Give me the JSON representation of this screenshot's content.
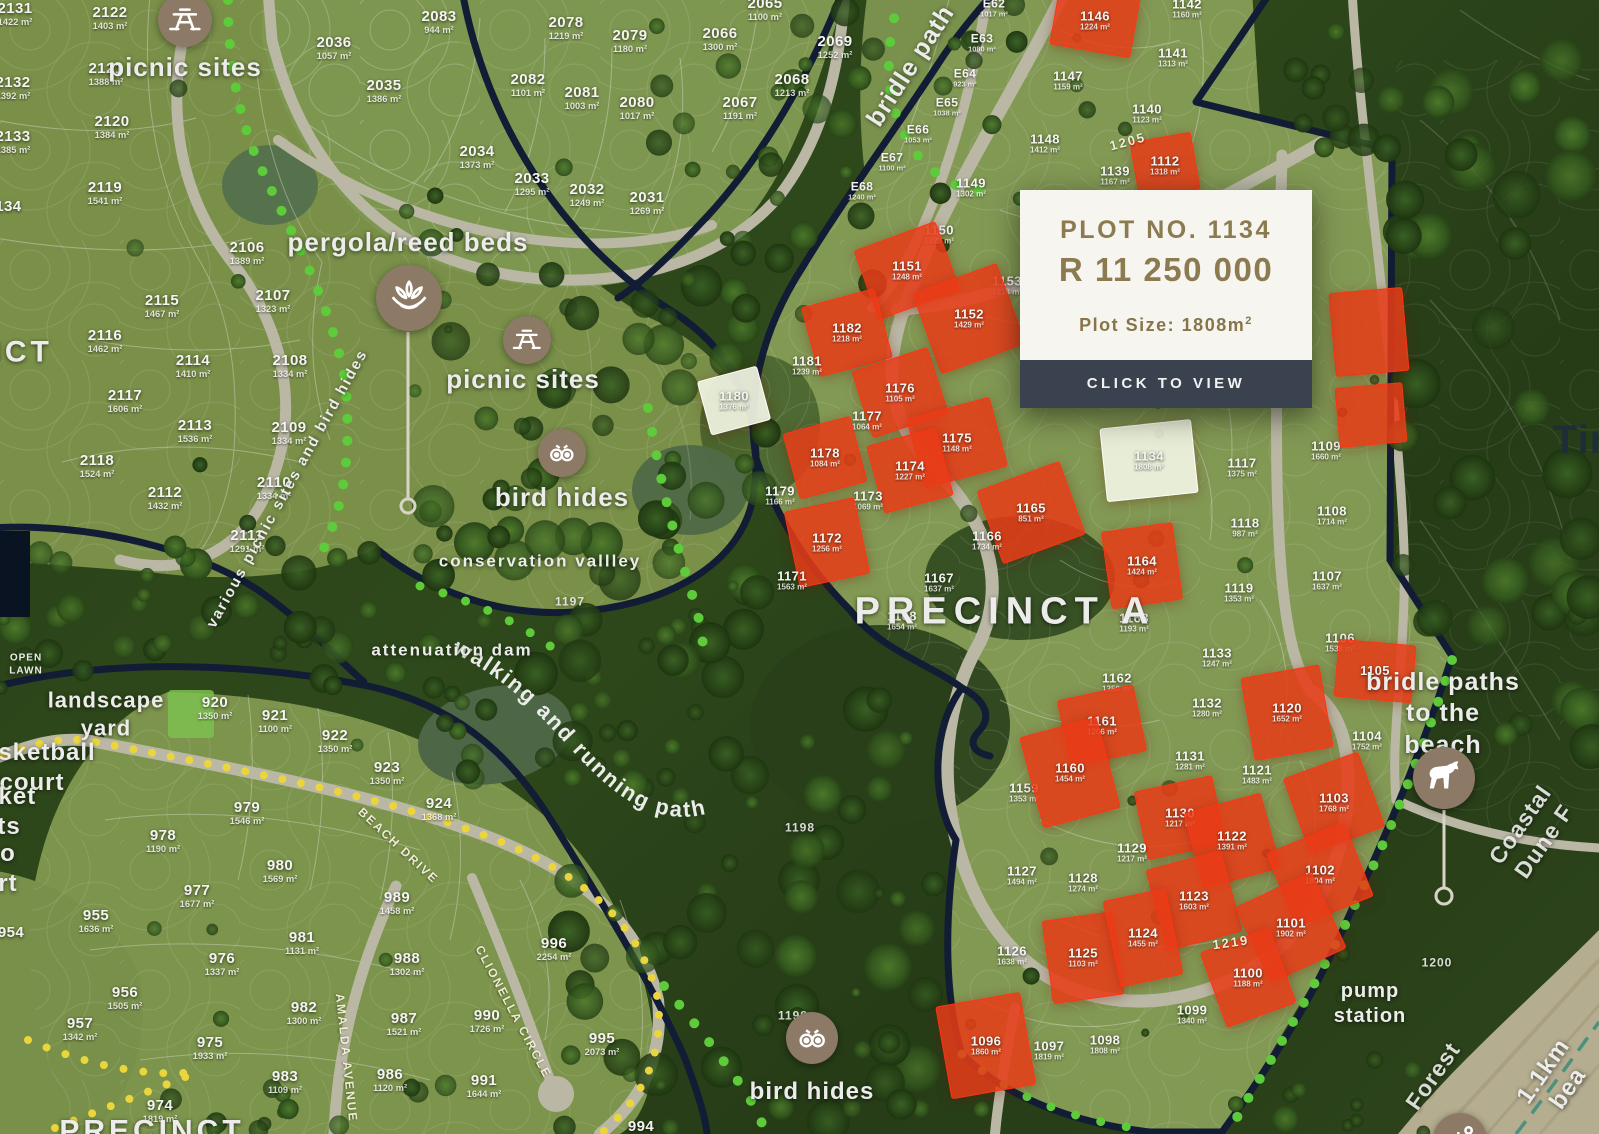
{
  "popup": {
    "plot_label": "PLOT NO. 1134",
    "price": "R 11 250 000",
    "size_label": "Plot Size: 1808m",
    "size_sup": "2",
    "button": "CLICK TO VIEW"
  },
  "colors": {
    "accent_gold": "#8c7b51",
    "button_bg": "#39424e",
    "sold_red": "#e83b17",
    "selected_plot": "#f0f4e3",
    "boundary_navy": "#13203c",
    "road": "#cfccb8",
    "trail_dot_green": "#5ecb3a",
    "trail_dot_yellow": "#ead63c"
  },
  "labels": [
    {
      "t": "picnic sites",
      "x": 185,
      "y": 67,
      "fs": 26
    },
    {
      "t": "pergola/reed beds",
      "x": 408,
      "y": 242,
      "fs": 26
    },
    {
      "t": "picnic sites",
      "x": 523,
      "y": 379,
      "fs": 26
    },
    {
      "t": "bird hides",
      "x": 562,
      "y": 497,
      "fs": 26
    },
    {
      "t": "conservation vallley",
      "x": 540,
      "y": 561,
      "fs": 17,
      "ls": 2
    },
    {
      "t": "attenuation dam",
      "x": 452,
      "y": 650,
      "fs": 17,
      "ls": 2
    },
    {
      "t": "various picnic sites and bird hides",
      "x": 288,
      "y": 489,
      "fs": 15,
      "rot": -61,
      "ls": 2
    },
    {
      "t": "bridle path",
      "x": 911,
      "y": 66,
      "fs": 25,
      "rot": -57
    },
    {
      "t": "PRECINCT A",
      "x": 1005,
      "y": 612,
      "fs": 38,
      "ls": 7
    },
    {
      "t": "bridle paths\nto the beach",
      "x": 1443,
      "y": 714,
      "fs": 25
    },
    {
      "t": "bird hides",
      "x": 812,
      "y": 1092,
      "fs": 24
    },
    {
      "t": "pump\nstation",
      "x": 1370,
      "y": 1004,
      "fs": 20
    },
    {
      "t": "OPEN\nLAWN",
      "x": 26,
      "y": 665,
      "fs": 10,
      "ls": 1
    },
    {
      "t": "landscape\nyard",
      "x": 106,
      "y": 714,
      "fs": 22
    },
    {
      "t": "basketball\ncourt",
      "x": 32,
      "y": 768,
      "fs": 24
    },
    {
      "t": "cricket\nnets",
      "x": -6,
      "y": 812,
      "fs": 24
    },
    {
      "t": "o\nrt",
      "x": 8,
      "y": 869,
      "fs": 24
    },
    {
      "t": "NCT",
      "x": 16,
      "y": 352,
      "fs": 30,
      "ls": 4
    },
    {
      "t": "PRECINCT",
      "x": 152,
      "y": 1131,
      "fs": 30,
      "ls": 4
    },
    {
      "t": "Tin",
      "x": 1584,
      "y": 440,
      "fs": 40,
      "cls": "dark"
    },
    {
      "t": "Coastal Dune F",
      "x": 1532,
      "y": 833,
      "fs": 23,
      "rot": -55,
      "op": 0.9
    },
    {
      "t": "Forest",
      "x": 1433,
      "y": 1076,
      "fs": 23,
      "rot": -55,
      "op": 0.9
    },
    {
      "t": "1.1km bea",
      "x": 1556,
      "y": 1080,
      "fs": 24,
      "rot": -55
    },
    {
      "t": "BEACH DRIVE",
      "x": 398,
      "y": 846,
      "fs": 12,
      "rot": 43,
      "cls": "rl"
    },
    {
      "t": "AMALDA AVENUE",
      "x": 346,
      "y": 1058,
      "fs": 12,
      "rot": 84,
      "cls": "rl"
    },
    {
      "t": "CLIONELLA CIRCLE",
      "x": 513,
      "y": 1012,
      "fs": 12,
      "rot": 62,
      "cls": "rl"
    },
    {
      "t": "1205",
      "x": 1128,
      "y": 142,
      "fs": 13,
      "rot": -15,
      "cls": "rl"
    },
    {
      "t": "1219",
      "x": 1231,
      "y": 943,
      "fs": 13,
      "rot": -8,
      "cls": "rl"
    },
    {
      "t": "1197",
      "x": 570,
      "y": 602,
      "fs": 12,
      "cls": "ref"
    },
    {
      "t": "1198",
      "x": 800,
      "y": 828,
      "fs": 12,
      "cls": "ref"
    },
    {
      "t": "1199",
      "x": 793,
      "y": 1016,
      "fs": 12,
      "cls": "ref"
    },
    {
      "t": "1200",
      "x": 1437,
      "y": 963,
      "fs": 12,
      "cls": "ref"
    }
  ],
  "icons": [
    {
      "name": "picnic-table",
      "g": "picnic",
      "x": 185,
      "y": 20,
      "r": 27
    },
    {
      "name": "lotus",
      "g": "lotus",
      "x": 409,
      "y": 298,
      "r": 33
    },
    {
      "name": "picnic-table",
      "g": "picnic",
      "x": 527,
      "y": 340,
      "r": 24
    },
    {
      "name": "binoculars",
      "g": "binoc",
      "x": 562,
      "y": 453,
      "r": 24
    },
    {
      "name": "binoculars",
      "g": "binoc",
      "x": 812,
      "y": 1038,
      "r": 26
    },
    {
      "name": "horse",
      "g": "horse",
      "x": 1444,
      "y": 778,
      "r": 31
    },
    {
      "name": "beach-umbrella",
      "g": "beach",
      "x": 1460,
      "y": 1140,
      "r": 27
    }
  ],
  "plots": [
    {
      "n": "2131",
      "a": "1422 m²",
      "x": 15,
      "y": 14,
      "fs": 15
    },
    {
      "n": "2122",
      "a": "1403 m²",
      "x": 110,
      "y": 18,
      "fs": 15
    },
    {
      "n": "2132",
      "a": "1392 m²",
      "x": 13,
      "y": 88,
      "fs": 15
    },
    {
      "n": "2121",
      "a": "1388 m²",
      "x": 106,
      "y": 74,
      "fs": 15
    },
    {
      "n": "2120",
      "a": "1384 m²",
      "x": 112,
      "y": 127,
      "fs": 15
    },
    {
      "n": "2133",
      "a": "1385 m²",
      "x": 13,
      "y": 142,
      "fs": 15
    },
    {
      "n": "2119",
      "a": "1541 m²",
      "x": 105,
      "y": 193,
      "fs": 15
    },
    {
      "n": "2134",
      "a": "",
      "x": 4,
      "y": 207,
      "fs": 15
    },
    {
      "n": "2106",
      "a": "1389 m²",
      "x": 247,
      "y": 253,
      "fs": 15
    },
    {
      "n": "2107",
      "a": "1323 m²",
      "x": 273,
      "y": 301,
      "fs": 15
    },
    {
      "n": "2115",
      "a": "1467 m²",
      "x": 162,
      "y": 306,
      "fs": 15
    },
    {
      "n": "2116",
      "a": "1462 m²",
      "x": 105,
      "y": 341,
      "fs": 15
    },
    {
      "n": "2114",
      "a": "1410 m²",
      "x": 193,
      "y": 366,
      "fs": 15
    },
    {
      "n": "2108",
      "a": "1334 m²",
      "x": 290,
      "y": 366,
      "fs": 15
    },
    {
      "n": "2117",
      "a": "1606 m²",
      "x": 125,
      "y": 401,
      "fs": 15
    },
    {
      "n": "2113",
      "a": "1536 m²",
      "x": 195,
      "y": 431,
      "fs": 15
    },
    {
      "n": "2109",
      "a": "1334 m²",
      "x": 289,
      "y": 433,
      "fs": 15
    },
    {
      "n": "2118",
      "a": "1524 m²",
      "x": 97,
      "y": 466,
      "fs": 15
    },
    {
      "n": "2110",
      "a": "1334 m²",
      "x": 274,
      "y": 488,
      "fs": 15
    },
    {
      "n": "2112",
      "a": "1432 m²",
      "x": 165,
      "y": 498,
      "fs": 15
    },
    {
      "n": "2111",
      "a": "1291 m²",
      "x": 247,
      "y": 541,
      "fs": 15
    },
    {
      "n": "2083",
      "a": "944 m²",
      "x": 439,
      "y": 22,
      "fs": 15
    },
    {
      "n": "2036",
      "a": "1057 m²",
      "x": 334,
      "y": 48,
      "fs": 15
    },
    {
      "n": "2035",
      "a": "1386 m²",
      "x": 384,
      "y": 91,
      "fs": 15
    },
    {
      "n": "2078",
      "a": "1219 m²",
      "x": 566,
      "y": 28,
      "fs": 15
    },
    {
      "n": "2079",
      "a": "1180 m²",
      "x": 630,
      "y": 41,
      "fs": 15
    },
    {
      "n": "2082",
      "a": "1101 m²",
      "x": 528,
      "y": 85,
      "fs": 15
    },
    {
      "n": "2081",
      "a": "1003 m²",
      "x": 582,
      "y": 98,
      "fs": 15
    },
    {
      "n": "2080",
      "a": "1017 m²",
      "x": 637,
      "y": 108,
      "fs": 15
    },
    {
      "n": "2034",
      "a": "1373 m²",
      "x": 477,
      "y": 157,
      "fs": 15
    },
    {
      "n": "2033",
      "a": "1295 m²",
      "x": 532,
      "y": 184,
      "fs": 15
    },
    {
      "n": "2032",
      "a": "1249 m²",
      "x": 587,
      "y": 195,
      "fs": 15
    },
    {
      "n": "2031",
      "a": "1269 m²",
      "x": 647,
      "y": 203,
      "fs": 15
    },
    {
      "n": "2065",
      "a": "1100 m²",
      "x": 765,
      "y": 9,
      "fs": 15
    },
    {
      "n": "2066",
      "a": "1300 m²",
      "x": 720,
      "y": 39,
      "fs": 15
    },
    {
      "n": "2069",
      "a": "1252 m²",
      "x": 835,
      "y": 47,
      "fs": 15
    },
    {
      "n": "2068",
      "a": "1213 m²",
      "x": 792,
      "y": 85,
      "fs": 15
    },
    {
      "n": "2067",
      "a": "1191 m²",
      "x": 740,
      "y": 108,
      "fs": 15
    },
    {
      "n": "E62",
      "a": "1017 m²",
      "x": 994,
      "y": 8,
      "fs": 12
    },
    {
      "n": "E63",
      "a": "1080 m²",
      "x": 982,
      "y": 43,
      "fs": 12
    },
    {
      "n": "E64",
      "a": "923 m²",
      "x": 965,
      "y": 78,
      "fs": 12
    },
    {
      "n": "E65",
      "a": "1038 m²",
      "x": 947,
      "y": 107,
      "fs": 12
    },
    {
      "n": "E66",
      "a": "1053 m²",
      "x": 918,
      "y": 134,
      "fs": 12
    },
    {
      "n": "E67",
      "a": "1100 m²",
      "x": 892,
      "y": 162,
      "fs": 12
    },
    {
      "n": "E68",
      "a": "1240 m²",
      "x": 862,
      "y": 191,
      "fs": 12
    },
    {
      "n": "1146",
      "a": "1224 m²",
      "x": 1095,
      "y": 21,
      "st": "s",
      "pw": 80,
      "ph": 60,
      "pr": 10
    },
    {
      "n": "1142",
      "a": "1160 m²",
      "x": 1187,
      "y": 9
    },
    {
      "n": "1141",
      "a": "1313 m²",
      "x": 1173,
      "y": 58
    },
    {
      "n": "1147",
      "a": "1159 m²",
      "x": 1068,
      "y": 81
    },
    {
      "n": "1140",
      "a": "1123 m²",
      "x": 1147,
      "y": 114
    },
    {
      "n": "1148",
      "a": "1412 m²",
      "x": 1045,
      "y": 144
    },
    {
      "n": "1112",
      "a": "1318 m²",
      "x": 1165,
      "y": 166,
      "st": "s",
      "pw": 60,
      "ph": 56,
      "pr": -10
    },
    {
      "n": "1139",
      "a": "1167 m²",
      "x": 1115,
      "y": 176
    },
    {
      "n": "1149",
      "a": "1302 m²",
      "x": 971,
      "y": 188
    },
    {
      "n": "1150",
      "a": "1223 m²",
      "x": 939,
      "y": 235
    },
    {
      "n": "1151",
      "a": "1248 m²",
      "x": 907,
      "y": 271,
      "st": "s",
      "pw": 85,
      "ph": 72,
      "pr": -20
    },
    {
      "n": "1153",
      "a": "1218 m²",
      "x": 1007,
      "y": 286
    },
    {
      "n": "1152",
      "a": "1429 m²",
      "x": 969,
      "y": 319,
      "st": "s",
      "pw": 88,
      "ph": 84,
      "pr": -20
    },
    {
      "n": "1182",
      "a": "1218 m²",
      "x": 847,
      "y": 333,
      "st": "s",
      "pw": 74,
      "ph": 70,
      "pr": -15
    },
    {
      "n": "1181",
      "a": "1239 m²",
      "x": 807,
      "y": 366
    },
    {
      "n": "1180",
      "a": "1376 m²",
      "x": 734,
      "y": 401,
      "st": "w",
      "pw": 60,
      "ph": 54,
      "pr": -15
    },
    {
      "n": "1176",
      "a": "1105 m²",
      "x": 900,
      "y": 393,
      "st": "s",
      "pw": 78,
      "ph": 68,
      "pr": -18
    },
    {
      "n": "1177",
      "a": "1064 m²",
      "x": 867,
      "y": 421
    },
    {
      "n": "1178",
      "a": "1084 m²",
      "x": 825,
      "y": 458,
      "st": "s",
      "pw": 68,
      "ph": 66,
      "pr": -15
    },
    {
      "n": "1175",
      "a": "1148 m²",
      "x": 957,
      "y": 443,
      "st": "s",
      "pw": 84,
      "ph": 70,
      "pr": -15
    },
    {
      "n": "1174",
      "a": "1227 m²",
      "x": 910,
      "y": 471,
      "st": "s",
      "pw": 70,
      "ph": 68,
      "pr": -15
    },
    {
      "n": "1179",
      "a": "1166 m²",
      "x": 780,
      "y": 496
    },
    {
      "n": "1173",
      "a": "1069 m²",
      "x": 868,
      "y": 501
    },
    {
      "n": "1172",
      "a": "1256 m²",
      "x": 827,
      "y": 543,
      "st": "s",
      "pw": 70,
      "ph": 76,
      "pr": -12
    },
    {
      "n": "1165",
      "a": "851 m²",
      "x": 1031,
      "y": 513,
      "st": "s",
      "pw": 86,
      "ph": 76,
      "pr": -20
    },
    {
      "n": "1166",
      "a": "1734 m²",
      "x": 987,
      "y": 541
    },
    {
      "n": "1171",
      "a": "1563 m²",
      "x": 792,
      "y": 581
    },
    {
      "n": "1167",
      "a": "1637 m²",
      "x": 939,
      "y": 583
    },
    {
      "n": "1168",
      "a": "1654 m²",
      "x": 902,
      "y": 621
    },
    {
      "n": "1134",
      "a": "1808 m²",
      "x": 1149,
      "y": 461,
      "st": "w",
      "pw": 90,
      "ph": 72,
      "pr": -6
    },
    {
      "n": "1117",
      "a": "1375 m²",
      "x": 1242,
      "y": 468
    },
    {
      "n": "1118",
      "a": "987 m²",
      "x": 1245,
      "y": 528
    },
    {
      "n": "1109",
      "a": "1660 m²",
      "x": 1326,
      "y": 451
    },
    {
      "n": "1108",
      "a": "1714 m²",
      "x": 1332,
      "y": 516
    },
    {
      "n": "1107",
      "a": "1637 m²",
      "x": 1327,
      "y": 581
    },
    {
      "n": "1106",
      "a": "1538 m²",
      "x": 1340,
      "y": 643
    },
    {
      "n": "1119",
      "a": "1353 m²",
      "x": 1239,
      "y": 593
    },
    {
      "n": "1133",
      "a": "1247 m²",
      "x": 1217,
      "y": 658
    },
    {
      "n": "1163",
      "a": "1193 m²",
      "x": 1134,
      "y": 623
    },
    {
      "n": "1164",
      "a": "1424 m²",
      "x": 1142,
      "y": 566,
      "st": "s",
      "pw": 70,
      "ph": 76,
      "pr": -8
    },
    {
      "n": "1105",
      "a": "",
      "x": 1375,
      "y": 671,
      "st": "s",
      "pw": 76,
      "ph": 56,
      "pr": 5
    },
    {
      "n": "1104",
      "a": "1752 m²",
      "x": 1367,
      "y": 741
    },
    {
      "n": "1162",
      "a": "1350 m²",
      "x": 1117,
      "y": 683
    },
    {
      "n": "1132",
      "a": "1280 m²",
      "x": 1207,
      "y": 708
    },
    {
      "n": "1120",
      "a": "1652 m²",
      "x": 1287,
      "y": 713,
      "st": "s",
      "pw": 78,
      "ph": 82,
      "pr": -10
    },
    {
      "n": "1161",
      "a": "1206 m²",
      "x": 1102,
      "y": 726,
      "st": "s",
      "pw": 76,
      "ph": 66,
      "pr": -12
    },
    {
      "n": "1131",
      "a": "1281 m²",
      "x": 1190,
      "y": 761
    },
    {
      "n": "1121",
      "a": "1483 m²",
      "x": 1257,
      "y": 775
    },
    {
      "n": "1159",
      "a": "1353 m²",
      "x": 1024,
      "y": 793
    },
    {
      "n": "1160",
      "a": "1454 m²",
      "x": 1070,
      "y": 773,
      "st": "s",
      "pw": 78,
      "ph": 92,
      "pr": -15
    },
    {
      "n": "1130",
      "a": "1217 m²",
      "x": 1180,
      "y": 818,
      "st": "s",
      "pw": 78,
      "ph": 68,
      "pr": -12
    },
    {
      "n": "1122",
      "a": "1391 m²",
      "x": 1232,
      "y": 841,
      "st": "s",
      "pw": 78,
      "ph": 76,
      "pr": -15
    },
    {
      "n": "1103",
      "a": "1768 m²",
      "x": 1334,
      "y": 803,
      "st": "s",
      "pw": 78,
      "ph": 78,
      "pr": -20
    },
    {
      "n": "1102",
      "a": "1804 m²",
      "x": 1320,
      "y": 875,
      "st": "s",
      "pw": 82,
      "ph": 78,
      "pr": -22
    },
    {
      "n": "1129",
      "a": "1217 m²",
      "x": 1132,
      "y": 853
    },
    {
      "n": "1127",
      "a": "1494 m²",
      "x": 1022,
      "y": 876
    },
    {
      "n": "1128",
      "a": "1274 m²",
      "x": 1083,
      "y": 883
    },
    {
      "n": "1123",
      "a": "1603 m²",
      "x": 1194,
      "y": 901,
      "st": "s",
      "pw": 76,
      "ph": 82,
      "pr": -15
    },
    {
      "n": "1101",
      "a": "1902 m²",
      "x": 1291,
      "y": 928,
      "st": "s",
      "pw": 82,
      "ph": 82,
      "pr": -25
    },
    {
      "n": "1126",
      "a": "1638 m²",
      "x": 1012,
      "y": 956
    },
    {
      "n": "1125",
      "a": "1103 m²",
      "x": 1083,
      "y": 958,
      "st": "s",
      "pw": 70,
      "ph": 82,
      "pr": -8
    },
    {
      "n": "1124",
      "a": "1455 m²",
      "x": 1143,
      "y": 938,
      "st": "s",
      "pw": 62,
      "ph": 86,
      "pr": -12
    },
    {
      "n": "1100",
      "a": "1188 m²",
      "x": 1248,
      "y": 978,
      "st": "s",
      "pw": 72,
      "ph": 78,
      "pr": -20
    },
    {
      "n": "1099",
      "a": "1340 m²",
      "x": 1192,
      "y": 1015
    },
    {
      "n": "1096",
      "a": "1860 m²",
      "x": 986,
      "y": 1046,
      "st": "s",
      "pw": 84,
      "ph": 92,
      "pr": -10
    },
    {
      "n": "1097",
      "a": "1819 m²",
      "x": 1049,
      "y": 1051
    },
    {
      "n": "1098",
      "a": "1808 m²",
      "x": 1105,
      "y": 1045
    },
    {
      "n": "",
      "a": "",
      "x": 1369,
      "y": 332,
      "st": "s",
      "pw": 72,
      "ph": 82,
      "pr": -5
    },
    {
      "n": "",
      "a": "",
      "x": 1371,
      "y": 415,
      "st": "s",
      "pw": 66,
      "ph": 58,
      "pr": -5
    },
    {
      "n": "920",
      "a": "1350 m²",
      "x": 215,
      "y": 708,
      "fs": 15
    },
    {
      "n": "921",
      "a": "1100 m²",
      "x": 275,
      "y": 721,
      "fs": 15
    },
    {
      "n": "922",
      "a": "1350 m²",
      "x": 335,
      "y": 741,
      "fs": 15
    },
    {
      "n": "923",
      "a": "1350 m²",
      "x": 387,
      "y": 773,
      "fs": 15
    },
    {
      "n": "924",
      "a": "1368 m²",
      "x": 439,
      "y": 809,
      "fs": 15
    },
    {
      "n": "979",
      "a": "1546 m²",
      "x": 247,
      "y": 813,
      "fs": 15
    },
    {
      "n": "978",
      "a": "1190 m²",
      "x": 163,
      "y": 841,
      "fs": 15
    },
    {
      "n": "955",
      "a": "1636 m²",
      "x": 96,
      "y": 921,
      "fs": 15
    },
    {
      "n": "977",
      "a": "1677 m²",
      "x": 197,
      "y": 896,
      "fs": 15
    },
    {
      "n": "980",
      "a": "1569 m²",
      "x": 280,
      "y": 871,
      "fs": 15
    },
    {
      "n": "989",
      "a": "1458 m²",
      "x": 397,
      "y": 903,
      "fs": 15
    },
    {
      "n": "996",
      "a": "2254 m²",
      "x": 554,
      "y": 949,
      "fs": 15
    },
    {
      "n": "981",
      "a": "1131 m²",
      "x": 302,
      "y": 943,
      "fs": 15
    },
    {
      "n": "976",
      "a": "1337 m²",
      "x": 222,
      "y": 964,
      "fs": 15
    },
    {
      "n": "988",
      "a": "1302 m²",
      "x": 407,
      "y": 964,
      "fs": 15
    },
    {
      "n": "956",
      "a": "1505 m²",
      "x": 125,
      "y": 998,
      "fs": 15
    },
    {
      "n": "982",
      "a": "1300 m²",
      "x": 304,
      "y": 1013,
      "fs": 15
    },
    {
      "n": "987",
      "a": "1521 m²",
      "x": 404,
      "y": 1024,
      "fs": 15
    },
    {
      "n": "957",
      "a": "1342 m²",
      "x": 80,
      "y": 1029,
      "fs": 15
    },
    {
      "n": "975",
      "a": "1933 m²",
      "x": 210,
      "y": 1048,
      "fs": 15
    },
    {
      "n": "990",
      "a": "1726 m²",
      "x": 487,
      "y": 1021,
      "fs": 15
    },
    {
      "n": "995",
      "a": "2073 m²",
      "x": 602,
      "y": 1044,
      "fs": 15
    },
    {
      "n": "983",
      "a": "1109 m²",
      "x": 285,
      "y": 1082,
      "fs": 15
    },
    {
      "n": "986",
      "a": "1120 m²",
      "x": 390,
      "y": 1080,
      "fs": 15
    },
    {
      "n": "991",
      "a": "1644 m²",
      "x": 484,
      "y": 1086,
      "fs": 15
    },
    {
      "n": "974",
      "a": "1819 m²",
      "x": 160,
      "y": 1111,
      "fs": 15
    },
    {
      "n": "954",
      "a": "",
      "x": 11,
      "y": 933,
      "fs": 15
    },
    {
      "n": "994",
      "a": "",
      "x": 641,
      "y": 1127,
      "fs": 15
    }
  ]
}
